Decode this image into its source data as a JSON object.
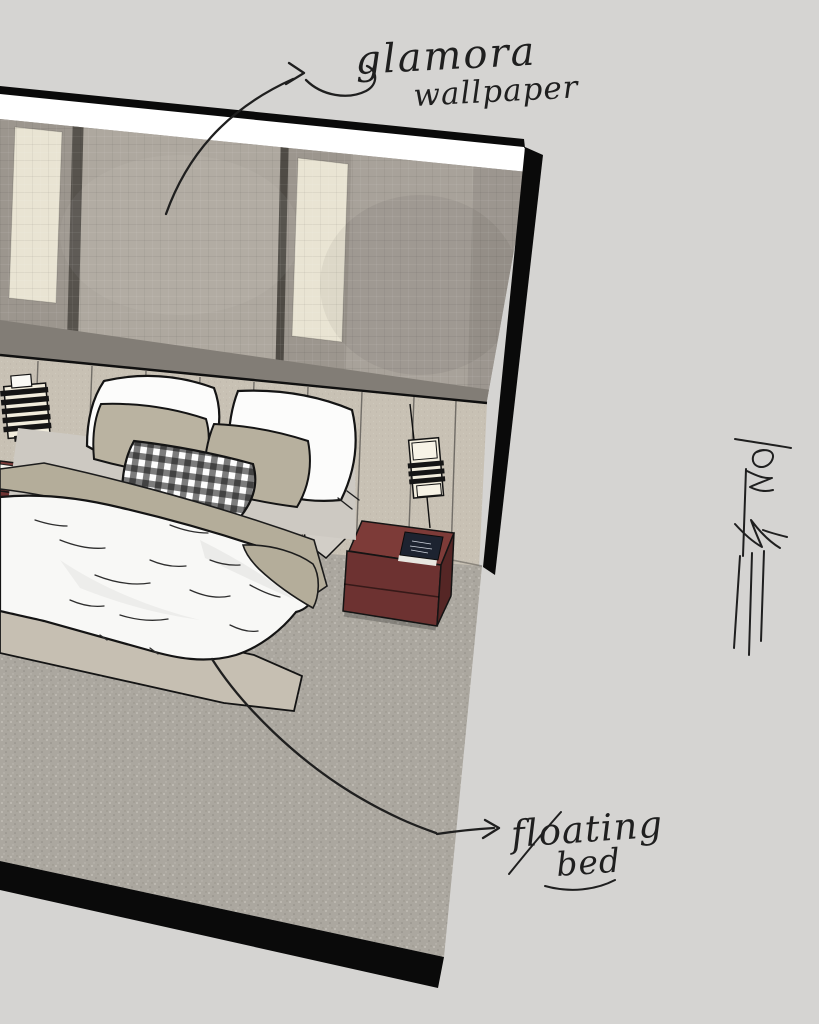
{
  "annotations": {
    "wallpaper_label": {
      "line1": "glamora",
      "line2": "wallpaper"
    },
    "bed_label": {
      "line1": "floating",
      "line2": "bed"
    }
  },
  "icons": {
    "left_sconce": "wall-sconce-icon",
    "right_sconce": "wall-sconce-icon",
    "signature": "signature-mark"
  },
  "colors": {
    "canvas_bg": "#d5d4d2",
    "ink": "#1f1f1f",
    "outline": "#141414",
    "ceiling": "#ffffff",
    "wall_base": "#a8a29a",
    "wall_panel_light": "#aea89f",
    "wall_panel_mid": "#9c968e",
    "wall_divider": "#57534d",
    "wall_strip_cream": "#e9e4d3",
    "wall_lower": "#827d76",
    "headboard": "#c8c1b4",
    "pillow_white": "#fcfcfb",
    "pillow_sage": "#bab3a1",
    "sheet": "#cdc9c2",
    "blanket_sage": "#b4ad9a",
    "duvet": "#f8f8f6",
    "bed_base": "#c6bfb2",
    "mattress_side": "#d2cec7",
    "nightstand_top": "#7d3b38",
    "nightstand_front": "#6d3231",
    "nightstand_side": "#552625",
    "book_navy": "#1d2330",
    "book_white": "#f4f2ec",
    "carpet": "#aba79f",
    "carpet_dot_light": "#c9c5bd",
    "carpet_dot_dark": "#918d86",
    "floor_edge": "#0a0a0a",
    "sconce_black": "#151515",
    "sconce_cream": "#f2eddd",
    "cable": "#101010"
  }
}
